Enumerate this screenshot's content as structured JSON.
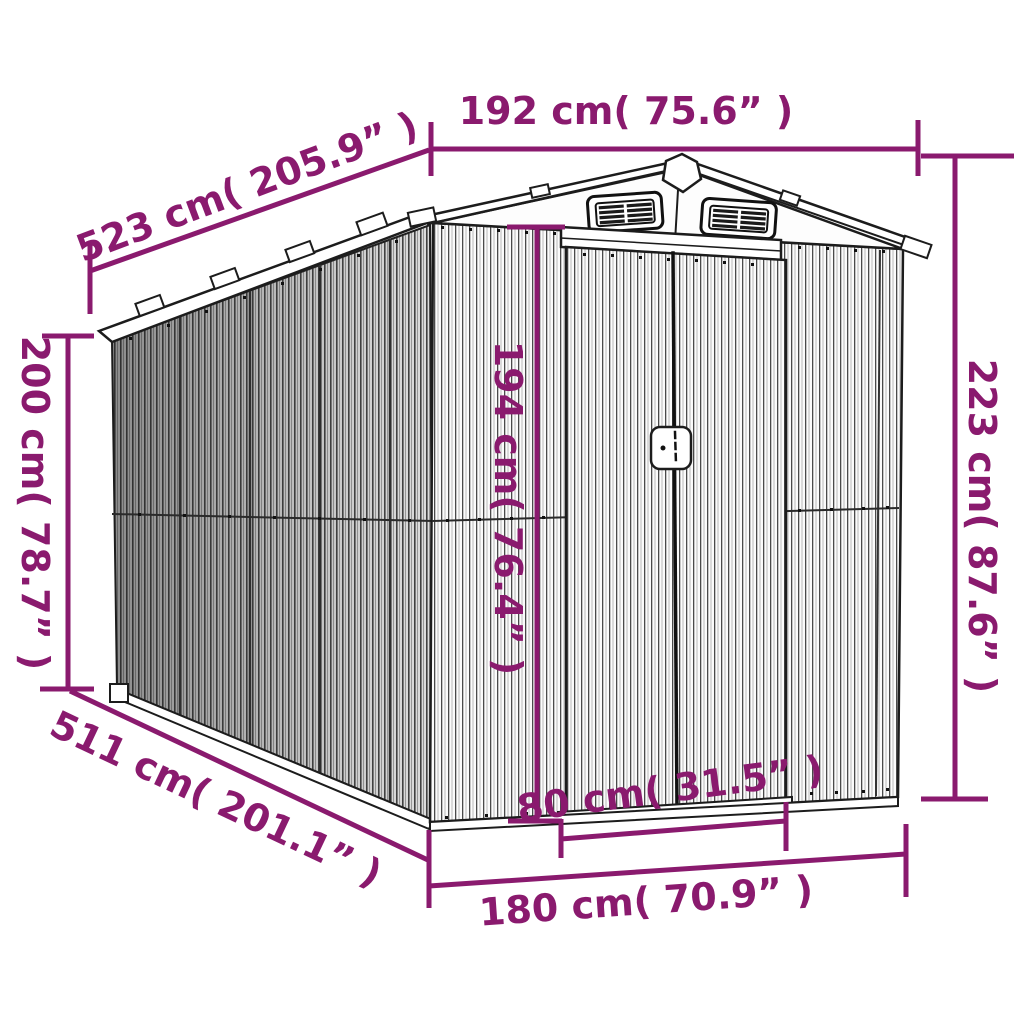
{
  "accent_color": "#8a1a6e",
  "line_color": "#1c1c1c",
  "dimensions": {
    "front_width": "192 cm( 75.6” )",
    "roof_length": "523 cm( 205.9” )",
    "wall_height": "200 cm( 78.7” )",
    "total_height": "223 cm( 87.6” )",
    "door_height": "194 cm( 76.4” )",
    "base_length": "511 cm( 201.1” )",
    "door_width": "80 cm( 31.5” )",
    "base_width": "180 cm( 70.9” )"
  }
}
